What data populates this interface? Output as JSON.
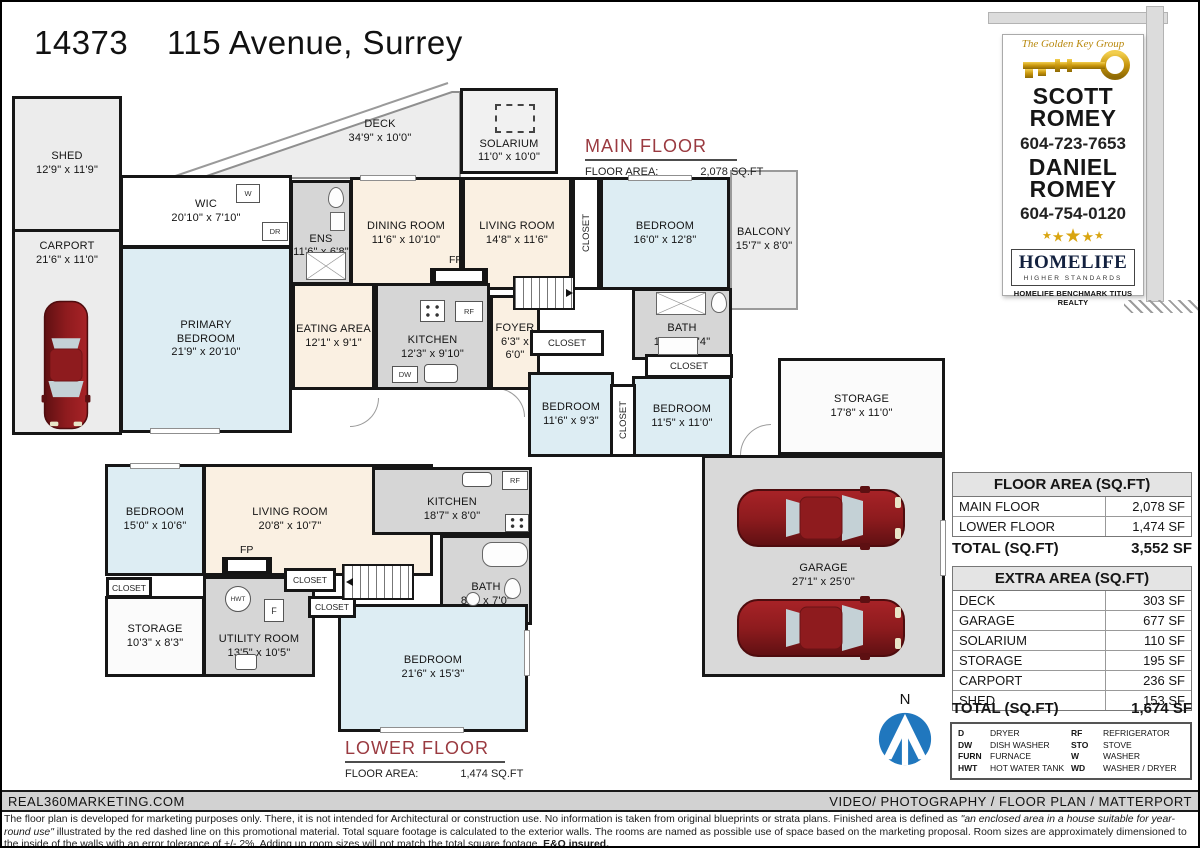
{
  "title": "14373    115 Avenue, Surrey",
  "sign": {
    "brand_script": "The Golden Key Group",
    "agent1_first": "SCOTT",
    "agent1_last": "ROMEY",
    "agent1_phone": "604-723-7653",
    "agent2_first": "DANIEL",
    "agent2_last": "ROMEY",
    "agent2_phone": "604-754-0120",
    "brand_name": "HOMELIFE",
    "brand_tagline": "HIGHER STANDARDS",
    "brokerage": "HOMELIFE BENCHMARK TITUS REALTY"
  },
  "main_floor": {
    "heading": "MAIN FLOOR",
    "area_label": "FLOOR AREA:",
    "area_value": "2,078 SQ.FT",
    "rooms": {
      "shed": {
        "name": "SHED",
        "dims": "12'9\" x 11'9\""
      },
      "carport": {
        "name": "CARPORT",
        "dims": "21'6\" x 11'0\""
      },
      "wic": {
        "name": "WIC",
        "dims": "20'10\" x 7'10\""
      },
      "ens": {
        "name": "ENS",
        "dims": "11'6\" x 6'8\""
      },
      "deck": {
        "name": "DECK",
        "dims": "34'9\" x 10'0\""
      },
      "solarium": {
        "name": "SOLARIUM",
        "dims": "11'0\" x 10'0\""
      },
      "dining": {
        "name": "DINING ROOM",
        "dims": "11'6\" x 10'10\""
      },
      "living": {
        "name": "LIVING ROOM",
        "dims": "14'8\" x 11'6\""
      },
      "bedroom_ne": {
        "name": "BEDROOM",
        "dims": "16'0\" x 12'8\""
      },
      "balcony": {
        "name": "BALCONY",
        "dims": "15'7\" x 8'0\""
      },
      "primary": {
        "name": "PRIMARY BEDROOM",
        "dims": "21'9\" x 20'10\""
      },
      "eating": {
        "name": "EATING AREA",
        "dims": "12'1\" x 9'1\""
      },
      "kitchen": {
        "name": "KITCHEN",
        "dims": "12'3\" x 9'10\""
      },
      "foyer": {
        "name": "FOYER",
        "dims": "6'3\" x 6'0\""
      },
      "bath": {
        "name": "BATH",
        "dims": "10'9\" x 7'4\""
      },
      "bedroom_s1": {
        "name": "BEDROOM",
        "dims": "11'6\" x 9'3\""
      },
      "bedroom_s2": {
        "name": "BEDROOM",
        "dims": "11'5\" x 11'0\""
      },
      "storage": {
        "name": "STORAGE",
        "dims": "17'8\" x 11'0\""
      },
      "garage": {
        "name": "GARAGE",
        "dims": "27'1\" x 25'0\""
      }
    }
  },
  "lower_floor": {
    "heading": "LOWER FLOOR",
    "area_label": "FLOOR AREA:",
    "area_value": "1,474 SQ.FT",
    "rooms": {
      "bedroom_nw": {
        "name": "BEDROOM",
        "dims": "15'0\" x 10'6\""
      },
      "living": {
        "name": "LIVING ROOM",
        "dims": "20'8\" x 10'7\""
      },
      "kitchen": {
        "name": "KITCHEN",
        "dims": "18'7\" x 8'0\""
      },
      "bath": {
        "name": "BATH",
        "dims": "8'0\" x 7'0\""
      },
      "storage": {
        "name": "STORAGE",
        "dims": "10'3\" x 8'3\""
      },
      "utility": {
        "name": "UTILITY ROOM",
        "dims": "13'5\" x 10'5\""
      },
      "bedroom_s": {
        "name": "BEDROOM",
        "dims": "21'6\" x 15'3\""
      }
    }
  },
  "labels": {
    "closet": "CLOSET",
    "fp": "FP",
    "w": "W",
    "dr": "DR",
    "rf": "RF",
    "dw": "DW",
    "hwt": "HWT",
    "f": "F",
    "north": "N"
  },
  "tables": {
    "floor_area": {
      "header": "FLOOR AREA (SQ.FT)",
      "rows": [
        [
          "MAIN FLOOR",
          "2,078 SF"
        ],
        [
          "LOWER FLOOR",
          "1,474 SF"
        ]
      ],
      "total_label": "TOTAL (SQ.FT)",
      "total_value": "3,552 SF"
    },
    "extra_area": {
      "header": "EXTRA AREA (SQ.FT)",
      "rows": [
        [
          "DECK",
          "303 SF"
        ],
        [
          "GARAGE",
          "677 SF"
        ],
        [
          "SOLARIUM",
          "110 SF"
        ],
        [
          "STORAGE",
          "195 SF"
        ],
        [
          "CARPORT",
          "236 SF"
        ],
        [
          "SHED",
          "153 SF"
        ]
      ],
      "total_label": "TOTAL (SQ.FT)",
      "total_value": "1,674 SF"
    }
  },
  "legend": {
    "items": [
      [
        "D",
        "DRYER"
      ],
      [
        "DW",
        "DISH WASHER"
      ],
      [
        "FURN",
        "FURNACE"
      ],
      [
        "HWT",
        "HOT WATER TANK"
      ],
      [
        "RF",
        "REFRIGERATOR"
      ],
      [
        "STO",
        "STOVE"
      ],
      [
        "W",
        "WASHER"
      ],
      [
        "WD",
        "WASHER / DRYER"
      ]
    ]
  },
  "footer": {
    "left": "REAL360MARKETING.COM",
    "right": "VIDEO/ PHOTOGRAPHY / FLOOR PLAN / MATTERPORT",
    "disclaimer_p1": "The floor plan is developed for marketing purposes only. There, it is not intended for Architectural or construction use. No information is  taken from original blueprints or strata plans. Finished area is defined as  ",
    "disclaimer_italic": "\"an enclosed area in a house suitable for year-round use\"",
    "disclaimer_p2": " illustrated by the red dashed line on this promotional material. Total square footage is calculated to the exterior walls. The rooms are named as possible use of space based on the marketing proposal. Room sizes are approximately dimensioned to the inside of the walls with an error tolerance of +/- 2%. Adding up room sizes will not match the total square footage. ",
    "disclaimer_bold": "E&O insured."
  },
  "colors": {
    "wall": "#161616",
    "bedroom": "#ddedf3",
    "living": "#faf0e2",
    "service": "#d6d6d6",
    "outdoor": "#ececec",
    "garage": "#d9d9d9",
    "accentRed": "#9a3a40",
    "compassBlue": "#2077be",
    "gold": "#d9a511",
    "carRed": "#8e1b1e"
  }
}
